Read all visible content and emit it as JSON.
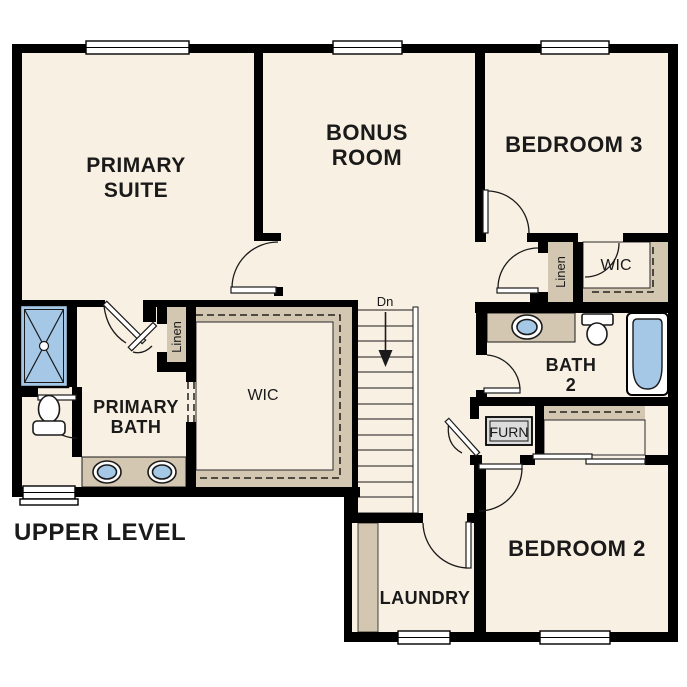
{
  "plan": {
    "title": "UPPER LEVEL",
    "rooms": {
      "primary_suite": {
        "name": "Primary Suite",
        "lines": [
          "PRIMARY",
          "SUITE"
        ]
      },
      "bonus_room": {
        "name": "Bonus Room",
        "lines": [
          "BONUS",
          "ROOM"
        ]
      },
      "bedroom_3": {
        "name": "Bedroom 3",
        "label": "BEDROOM 3"
      },
      "bedroom_2": {
        "name": "Bedroom 2",
        "label": "BEDROOM 2"
      },
      "primary_bath": {
        "name": "Primary Bath",
        "lines": [
          "PRIMARY",
          "BATH"
        ]
      },
      "bath_2": {
        "name": "Bath 2",
        "lines": [
          "BATH",
          "2"
        ]
      },
      "laundry": {
        "name": "Laundry",
        "label": "LAUNDRY"
      },
      "primary_wic": {
        "name": "Primary Walk-in Closet",
        "label": "WIC"
      },
      "bedroom3_wic": {
        "name": "Bedroom 3 Walk-in Closet",
        "label": "WIC"
      },
      "primary_linen": {
        "name": "Primary Linen Closet",
        "label": "Linen"
      },
      "hall_linen": {
        "name": "Hall Linen Closet",
        "label": "Linen"
      },
      "furnace_closet": {
        "name": "Furnace Closet",
        "label": "FURN"
      }
    },
    "stairs": {
      "label": "Dn",
      "direction": "down"
    },
    "fixtures": [
      "shower",
      "toilet",
      "double-vanity-sink",
      "vanity-sink",
      "bathtub"
    ],
    "colors": {
      "background": "#ffffff",
      "floor": "#f8f0e2",
      "casework": "#d3c7b1",
      "fixture_blue": "#a5c8e6",
      "wall": "#000000",
      "text": "#1a1a1a"
    }
  }
}
